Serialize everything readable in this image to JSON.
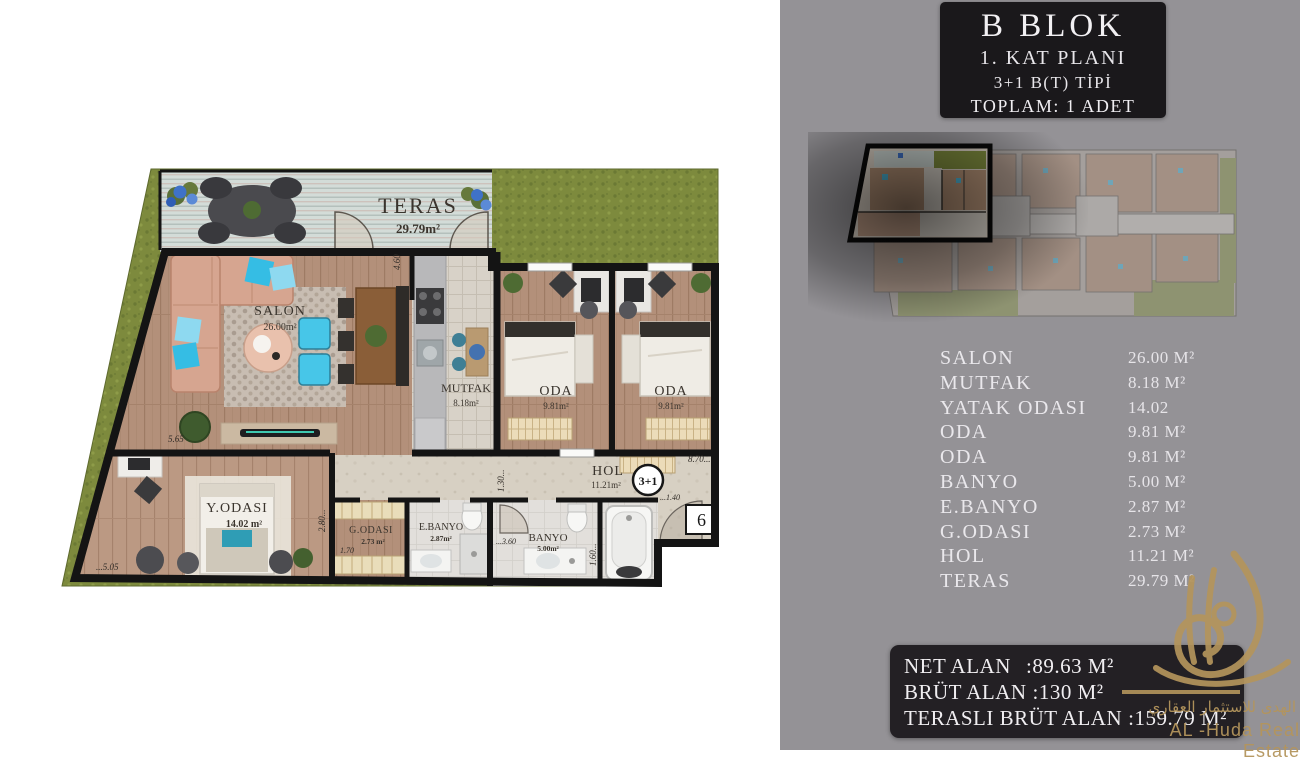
{
  "panel": {
    "header": {
      "title": "B BLOK",
      "line2": "1. KAT PLANI",
      "line3": "3+1 B(T) TİPİ",
      "line4": "TOPLAM: 1 ADET"
    },
    "rooms": [
      {
        "name": "SALON",
        "area": "26.00 M²"
      },
      {
        "name": "MUTFAK",
        "area": "8.18 M²"
      },
      {
        "name": "YATAK ODASI",
        "area": "14.02"
      },
      {
        "name": "ODA",
        "area": "9.81 M²"
      },
      {
        "name": "ODA",
        "area": "9.81 M²"
      },
      {
        "name": "BANYO",
        "area": "5.00 M²"
      },
      {
        "name": "E.BANYO",
        "area": "2.87 M²"
      },
      {
        "name": "G.ODASI",
        "area": "2.73 M²"
      },
      {
        "name": "HOL",
        "area": "11.21 M²"
      },
      {
        "name": "TERAS",
        "area": "29.79 M²"
      }
    ],
    "summary": [
      {
        "label": "NET ALAN",
        "value": ":89.63 M²"
      },
      {
        "label": "BRÜT ALAN",
        "value": ":130 M²"
      },
      {
        "label": "TERASLI BRÜT ALAN",
        "value": ":159.79 M²"
      }
    ],
    "logo": {
      "arabic": "الهدى للاستثمار العقاري",
      "latin": "AL -Huda Real Estate"
    }
  },
  "floorplan": {
    "teras": {
      "name": "TERAS",
      "area": "29.79m²"
    },
    "salon": {
      "name": "SALON",
      "area": "26.00m²"
    },
    "mutfak": {
      "name": "MUTFAK",
      "area": "8.18m²"
    },
    "oda1": {
      "name": "ODA",
      "area": "9.81m²"
    },
    "oda2": {
      "name": "ODA",
      "area": "9.81m²"
    },
    "yodasi": {
      "name": "Y.ODASI",
      "area": "14.02 m²"
    },
    "godasi": {
      "name": "G.ODASI",
      "area": "2.73 m²"
    },
    "ebanyo": {
      "name": "E.BANYO",
      "area": "2.87m²"
    },
    "banyo": {
      "name": "BANYO",
      "area": "5.00m²"
    },
    "hol": {
      "name": "HOL",
      "area": "11.21m²"
    },
    "type_badge": "3+1",
    "unit_number": "6",
    "dims": [
      "4.60",
      "5.65",
      "...5.05",
      "2.80...",
      "1.70",
      "...3.60",
      "1.30...",
      "1.60...",
      "8.70...",
      "...1.40"
    ]
  },
  "colors": {
    "panel_gray": "#949296",
    "box_dark": "#1a181b",
    "gold": "#b4955c",
    "grass": "#7d8a3d",
    "accent_teal": "#45c5ea"
  }
}
